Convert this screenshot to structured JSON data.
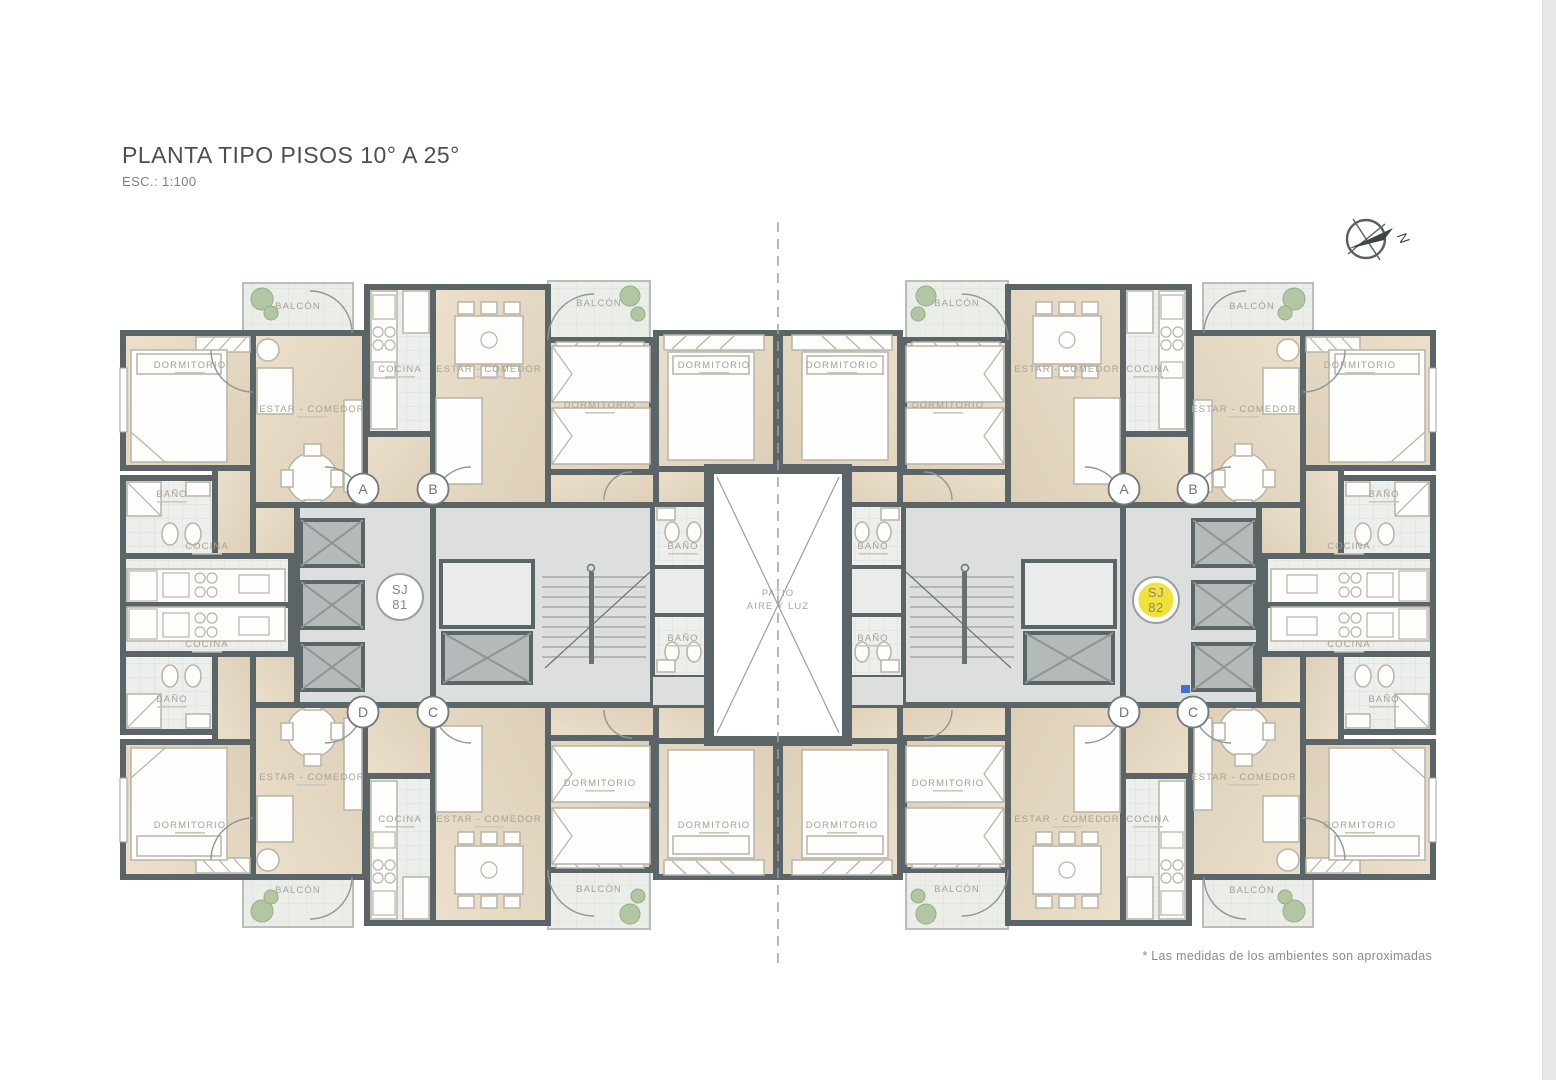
{
  "page": {
    "title": "PLANTA TIPO PISOS 10° A 25°",
    "scale_label": "ESC.: 1:100",
    "footnote": "* Las medidas de los ambientes son aproximadas"
  },
  "plan": {
    "north_label": "N",
    "patio_label": {
      "lines": [
        "PATIO",
        "AIRE Y LUZ"
      ],
      "x": 778,
      "y": 596
    },
    "unit_markers": [
      {
        "id": "SJ 81",
        "lines": [
          "SJ",
          "81"
        ],
        "x": 400,
        "y": 597,
        "highlight": false
      },
      {
        "id": "SJ 82",
        "lines": [
          "SJ",
          "82"
        ],
        "x": 1156,
        "y": 600,
        "highlight": true
      }
    ],
    "axis_markers": [
      {
        "label": "A",
        "x": 363,
        "y": 489
      },
      {
        "label": "B",
        "x": 433,
        "y": 489
      },
      {
        "label": "D",
        "x": 363,
        "y": 712
      },
      {
        "label": "C",
        "x": 433,
        "y": 712
      },
      {
        "label": "A",
        "x": 1124,
        "y": 489
      },
      {
        "label": "B",
        "x": 1193,
        "y": 489
      },
      {
        "label": "D",
        "x": 1124,
        "y": 712
      },
      {
        "label": "C",
        "x": 1193,
        "y": 712
      }
    ],
    "room_labels": [
      {
        "text": "BALCÓN",
        "x": 298,
        "y": 309
      },
      {
        "text": "DORMITORIO",
        "x": 190,
        "y": 368
      },
      {
        "text": "ESTAR - COMEDOR",
        "x": 312,
        "y": 412
      },
      {
        "text": "COCINA",
        "x": 400,
        "y": 372
      },
      {
        "text": "ESTAR - COMEDOR",
        "x": 489,
        "y": 372
      },
      {
        "text": "BALCÓN",
        "x": 599,
        "y": 306
      },
      {
        "text": "DORMITORIO",
        "x": 600,
        "y": 408
      },
      {
        "text": "DORMITORIO",
        "x": 714,
        "y": 368
      },
      {
        "text": "DORMITORIO",
        "x": 842,
        "y": 368
      },
      {
        "text": "BALCÓN",
        "x": 957,
        "y": 306
      },
      {
        "text": "DORMITORIO",
        "x": 948,
        "y": 408
      },
      {
        "text": "ESTAR - COMEDOR",
        "x": 1067,
        "y": 372
      },
      {
        "text": "COCINA",
        "x": 1148,
        "y": 372
      },
      {
        "text": "ESTAR - COMEDOR",
        "x": 1244,
        "y": 412
      },
      {
        "text": "DORMITORIO",
        "x": 1360,
        "y": 368
      },
      {
        "text": "BALCÓN",
        "x": 1252,
        "y": 309
      },
      {
        "text": "BAÑO",
        "x": 172,
        "y": 497
      },
      {
        "text": "COCINA",
        "x": 207,
        "y": 549
      },
      {
        "text": "COCINA",
        "x": 207,
        "y": 647
      },
      {
        "text": "BAÑO",
        "x": 172,
        "y": 702
      },
      {
        "text": "BAÑO",
        "x": 683,
        "y": 549
      },
      {
        "text": "BAÑO",
        "x": 683,
        "y": 641
      },
      {
        "text": "BAÑO",
        "x": 873,
        "y": 549
      },
      {
        "text": "BAÑO",
        "x": 873,
        "y": 641
      },
      {
        "text": "COCINA",
        "x": 1349,
        "y": 549
      },
      {
        "text": "COCINA",
        "x": 1349,
        "y": 647
      },
      {
        "text": "BAÑO",
        "x": 1384,
        "y": 497
      },
      {
        "text": "BAÑO",
        "x": 1384,
        "y": 702
      },
      {
        "text": "BALCÓN",
        "x": 298,
        "y": 893
      },
      {
        "text": "DORMITORIO",
        "x": 190,
        "y": 828
      },
      {
        "text": "ESTAR - COMEDOR",
        "x": 312,
        "y": 780
      },
      {
        "text": "COCINA",
        "x": 400,
        "y": 822
      },
      {
        "text": "ESTAR - COMEDOR",
        "x": 489,
        "y": 822
      },
      {
        "text": "BALCÓN",
        "x": 599,
        "y": 892
      },
      {
        "text": "DORMITORIO",
        "x": 600,
        "y": 786
      },
      {
        "text": "DORMITORIO",
        "x": 714,
        "y": 828
      },
      {
        "text": "DORMITORIO",
        "x": 842,
        "y": 828
      },
      {
        "text": "BALCÓN",
        "x": 957,
        "y": 892
      },
      {
        "text": "DORMITORIO",
        "x": 948,
        "y": 786
      },
      {
        "text": "ESTAR - COMEDOR",
        "x": 1067,
        "y": 822
      },
      {
        "text": "COCINA",
        "x": 1148,
        "y": 822
      },
      {
        "text": "ESTAR - COMEDOR",
        "x": 1244,
        "y": 780
      },
      {
        "text": "DORMITORIO",
        "x": 1360,
        "y": 828
      },
      {
        "text": "BALCÓN",
        "x": 1252,
        "y": 893
      }
    ]
  },
  "colors": {
    "wall": "#5b6467",
    "wood_floor": "#e7dbc7",
    "tile_floor": "#edefec",
    "balcony_floor": "#eaede8",
    "core_floor": "#dcdfdd",
    "shaft_fill": "#b4bab9",
    "highlight_yellow": "#f2e139",
    "label_gray": "#a7a196",
    "blue_marker": "#3f6fd0"
  }
}
